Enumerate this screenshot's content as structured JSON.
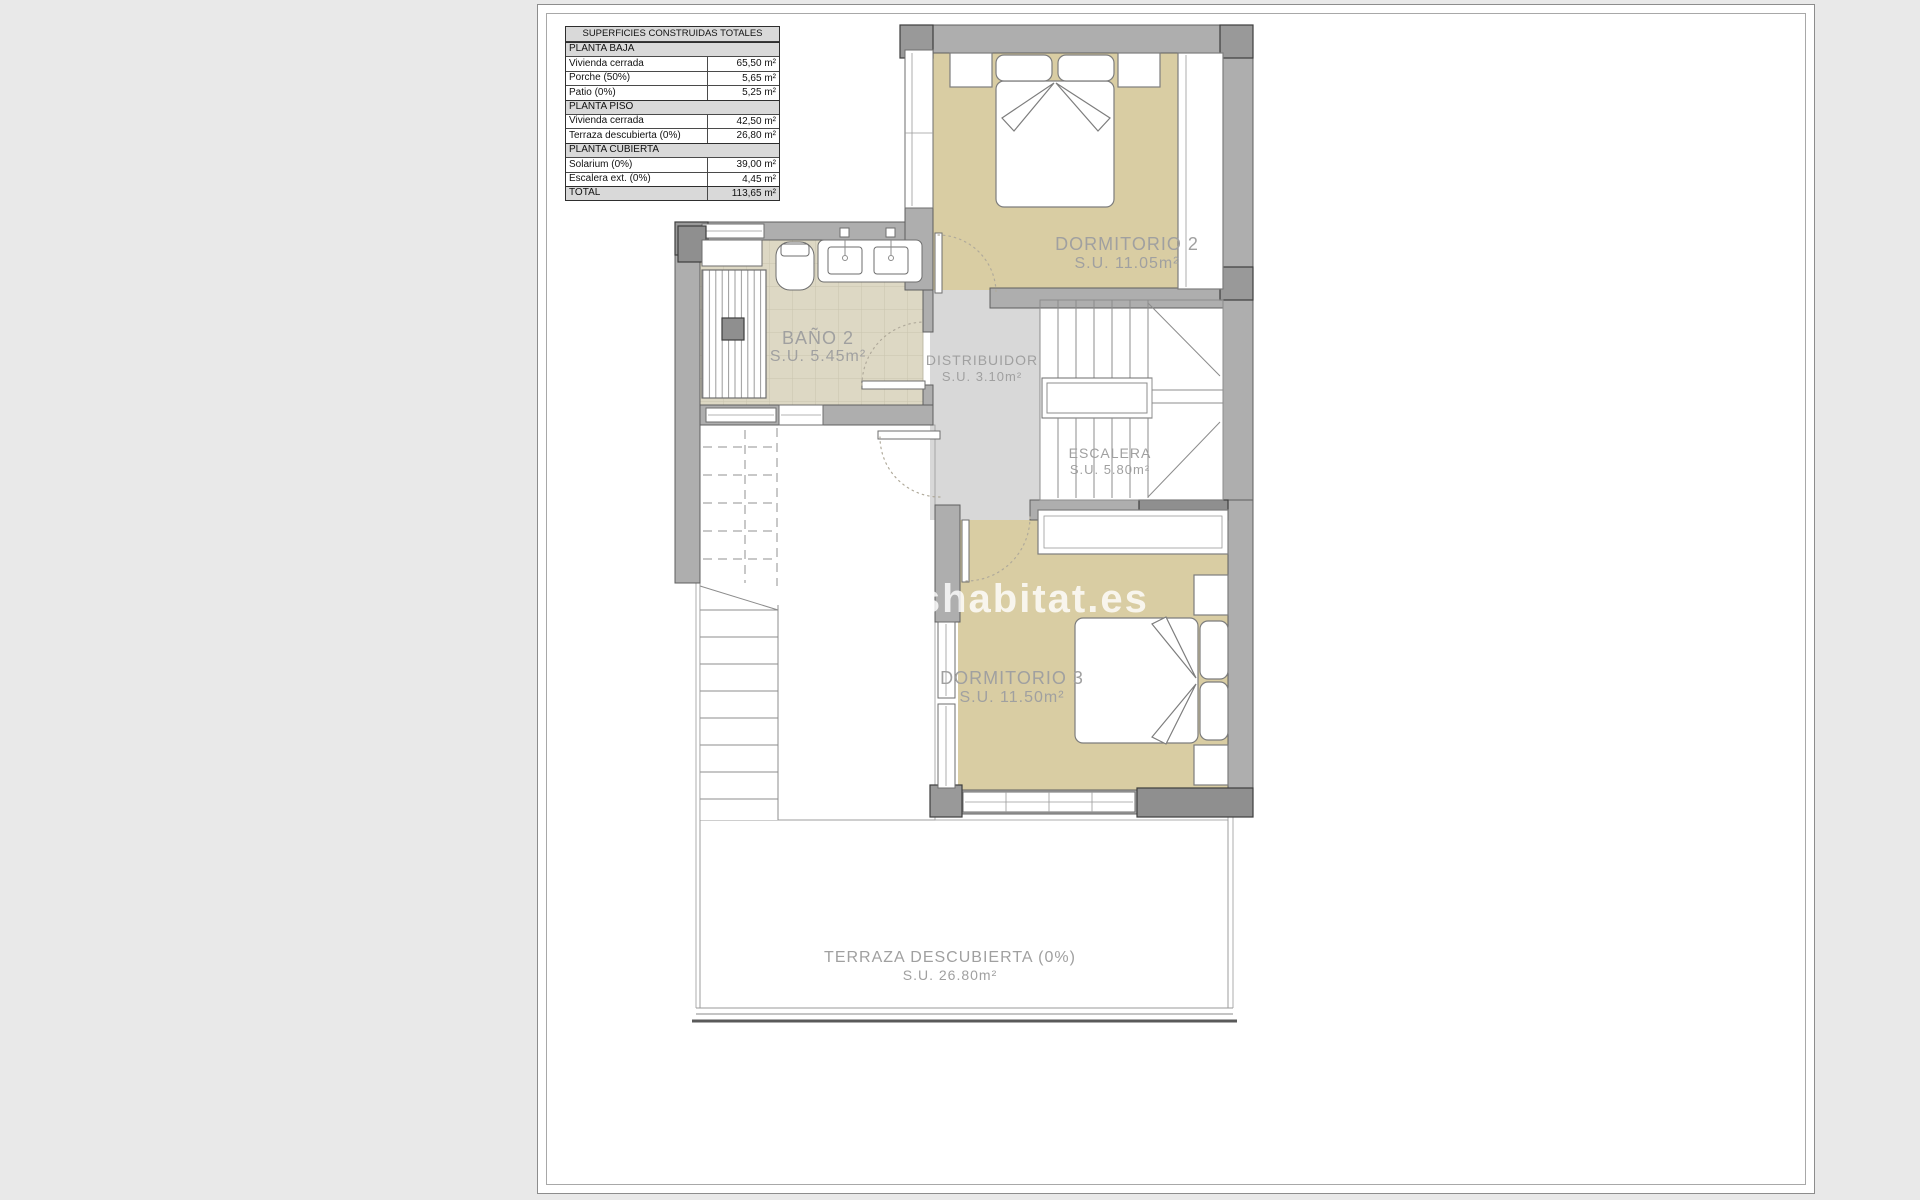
{
  "sheet": {
    "kind": "architectural floor plan sheet"
  },
  "table": {
    "title": "SUPERFICIES CONSTRUIDAS TOTALES",
    "rows": [
      {
        "type": "section",
        "label": "PLANTA BAJA"
      },
      {
        "type": "data",
        "label": "Vivienda cerrada",
        "value": "65,50 m²"
      },
      {
        "type": "data",
        "label": "Porche (50%)",
        "value": "5,65 m²"
      },
      {
        "type": "data",
        "label": "Patio (0%)",
        "value": "5,25 m²"
      },
      {
        "type": "section",
        "label": "PLANTA PISO"
      },
      {
        "type": "data",
        "label": "Vivienda cerrada",
        "value": "42,50 m²"
      },
      {
        "type": "data",
        "label": "Terraza descubierta (0%)",
        "value": "26,80 m²"
      },
      {
        "type": "section",
        "label": "PLANTA CUBIERTA"
      },
      {
        "type": "data",
        "label": "Solarium (0%)",
        "value": "39,00 m²"
      },
      {
        "type": "data",
        "label": "Escalera ext. (0%)",
        "value": "4,45 m²"
      },
      {
        "type": "total",
        "label": "TOTAL",
        "value": "113,65 m²"
      }
    ]
  },
  "rooms": [
    {
      "name": "DORMITORIO 2",
      "area": "S.U. 11.05m²"
    },
    {
      "name": "BAÑO 2",
      "area": "S.U. 5.45m²"
    },
    {
      "name": "DISTRIBUIDOR",
      "area": "S.U. 3.10m²"
    },
    {
      "name": "ESCALERA",
      "area": "S.U. 5.80m²"
    },
    {
      "name": "DORMITORIO 3",
      "area": "S.U. 11.50m²"
    },
    {
      "name": "TERRAZA DESCUBIERTA (0%)",
      "area": "S.U. 26.80m²"
    }
  ],
  "watermark": "yushabitat.es",
  "colors": {
    "canvas_bg": "#e9e9e9",
    "sheet_bg": "#ffffff",
    "wall": "#aeaeae",
    "pillar": "#999999",
    "wall_dark": "#8f8f8f",
    "beige": "#d9cda3",
    "bath_tile": "#ddd8c4",
    "bath_tile_line": "#c9c4ae",
    "floor_gray": "#d8d8d8",
    "tile_line": "#b3b3b3",
    "label": "#a0a0a0",
    "table_head_bg": "#d9d9d9",
    "line": "#8c8c8c",
    "watermark": "rgba(255,255,255,0.8)"
  }
}
